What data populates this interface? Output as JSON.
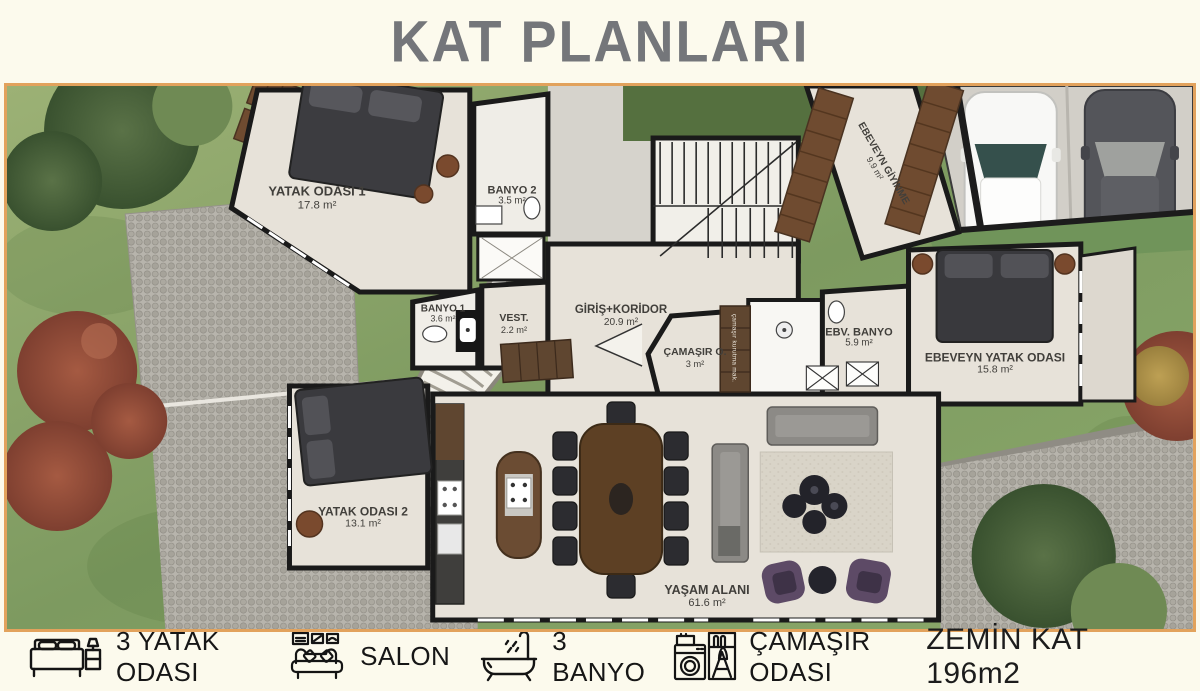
{
  "title": "KAT PLANLARI",
  "colors": {
    "page_background": "#fcfaed",
    "title_gray": "#74767a",
    "plan_border_orange": "#e2a25c",
    "floor_cream": "#e7e2d9",
    "wall_black": "#1a1a1a",
    "grass_green": "#8aa86a",
    "tree_red": "#8f4b3b",
    "wood_brown": "#6f4b30",
    "sofa_gray": "#8c8a86",
    "pouf_purple": "#5d4a66"
  },
  "plan": {
    "rooms": [
      {
        "name": "YATAK ODASI 1",
        "area": "17.8 m²"
      },
      {
        "name": "BANYO 2",
        "area": "3.5 m²"
      },
      {
        "name": "EBEVEYN GİYİNME",
        "area": "9.9 m²"
      },
      {
        "name": "BANYO 1",
        "area": "3.6 m²"
      },
      {
        "name": "VEST.",
        "area": "2.2 m²"
      },
      {
        "name": "GİRİŞ+KORİDOR",
        "area": "20.9 m²"
      },
      {
        "name": "ÇAMAŞIR O.",
        "area": "3 m²"
      },
      {
        "name": "EBV. BANYO",
        "area": "5.9 m²"
      },
      {
        "name": "EBEVEYN YATAK ODASI",
        "area": "15.8 m²"
      },
      {
        "name": "YATAK ODASI 2",
        "area": "13.1 m²"
      },
      {
        "name": "YAŞAM ALANI",
        "area": "61.6 m²"
      }
    ],
    "closet_note": "çamaşır kurutma mak."
  },
  "legend": {
    "items": [
      {
        "icon": "bed-icon",
        "label": "3 YATAK ODASI"
      },
      {
        "icon": "sofa-icon",
        "label": "SALON"
      },
      {
        "icon": "bathtub-icon",
        "label": "3 BANYO"
      },
      {
        "icon": "washing-machine-icon",
        "label": "ÇAMAŞIR ODASI"
      }
    ],
    "floor_label": "ZEMİN KAT 196m2"
  }
}
